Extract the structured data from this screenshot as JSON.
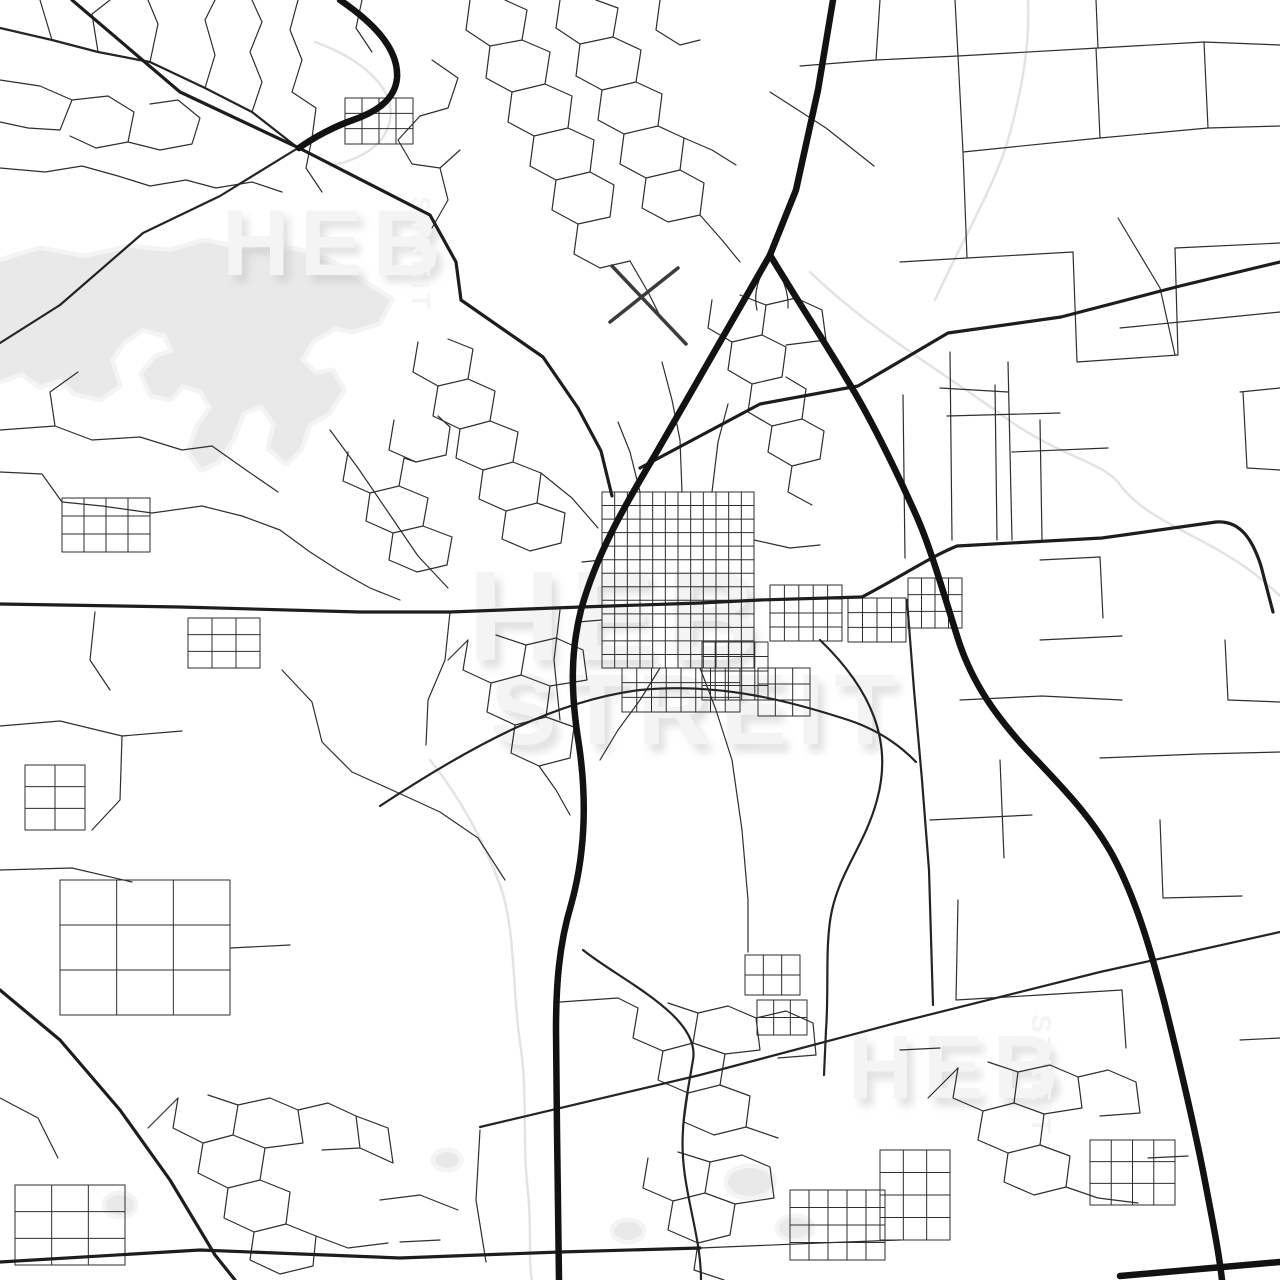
{
  "meta": {
    "background": "#ffffff",
    "image_kind": "street map poster preview"
  },
  "watermark": {
    "color": "#f4f4f4",
    "shadow_color": "#bdbdbd",
    "instances": [
      {
        "id": "center-heb",
        "text": "HEB"
      },
      {
        "id": "center-streit",
        "text": "STREIT"
      },
      {
        "id": "topleft-heb",
        "text": "HEB"
      },
      {
        "id": "topleft-streit",
        "text": "STREIT"
      },
      {
        "id": "bottomright-heb",
        "text": "HEB"
      },
      {
        "id": "bottomright-streit",
        "text": "STREIT"
      }
    ]
  },
  "map": {
    "water": {
      "fill": "#e9e9e9",
      "halo": "#f4f4f4",
      "shapes": [
        "M0,262 L40,250 L85,258 L130,248 L170,252 L205,242 L240,250 L270,246 L300,252 L330,262 L355,278 L390,300 L378,322 L352,330 L335,326 L312,340 L300,360 L315,375 L332,372 L342,390 L328,412 L308,424 L300,448 L286,462 L270,448 L276,424 L262,404 L242,412 L232,438 L218,460 L202,468 L190,452 L198,428 L212,408 L202,390 L182,384 L170,398 L152,394 L143,374 L156,358 L174,352 L166,334 L142,328 L122,342 L110,360 L118,385 L100,398 L75,392 L60,378 L40,385 L22,372 L0,380 Z",
        "M106,1205 a14,10 0 1 0 28,0 a14,10 0 1 0 -28,0 Z",
        "M728,1182 a22,14 0 1 0 44,0 a22,14 0 1 0 -44,0 Z",
        "M779,1228 a16,10 0 1 0 32,0 a16,10 0 1 0 -32,0 Z",
        "M614,1231 a14,9 0 1 0 28,0 a14,9 0 1 0 -28,0 Z",
        "M435,1160 a12,8 0 1 0 24,0 a12,8 0 1 0 -24,0 Z"
      ]
    },
    "streams": {
      "stroke": "#e3e3e3",
      "width": 2.5,
      "paths": [
        "M810,272 C870,330 940,370 1013,423 C1060,455 1100,462 1118,482 C1140,515 1190,532 1228,556 C1255,572 1268,585 1280,596",
        "M1028,0 C1030,45 1022,90 1008,140 C995,185 960,245 935,300",
        "M430,760 C462,800 485,845 500,885 C516,930 512,990 520,1042 C528,1092 522,1142 528,1192 C532,1232 528,1258 532,1280",
        "M315,42 C360,58 396,88 390,120 C385,147 358,160 330,166"
      ]
    },
    "layers": [
      {
        "name": "minor-roads",
        "type": "paths",
        "stroke": "#2e2e2e",
        "width": 1.2,
        "paths": [
          "M40,0 L52,40",
          "M98,52 L92,14 L110,0",
          "M150,62 L158,24 L148,0",
          "M205,88 L215,55 L205,20 L215,0",
          "M0,80 L40,86 L72,100 L60,130 L28,128 L0,122",
          "M72,100 L108,96 L134,112 L128,142 L96,148 L70,136",
          "M128,142 L160,150 L192,144 L200,118 L178,100 L150,104",
          "M0,168 L45,172 L82,166 L118,176",
          "M118,176 L150,186 L186,180 L216,188",
          "M216,188 L252,182 L282,192",
          "M252,112 L262,82 L250,52 L262,22 L252,0",
          "M298,0 L290,30 L302,60 L292,92",
          "M292,92 L316,108 L312,138",
          "M362,0 L356,28 L372,52",
          "M432,60 L458,78 L448,108 L420,116",
          "M420,116 L398,140 L412,164 L440,168 L460,150",
          "M440,168 L448,200 L432,228",
          "M312,138 L306,168 L322,192",
          "M470,0 L466,30 L490,46 L522,40 L527,10 L505,0",
          "M490,46 L486,78 L512,92 L545,84 L550,52 L522,40",
          "M512,92 L508,122 L534,136 L568,128 L572,96 L545,84",
          "M560,0 L556,28 L580,44 L613,37 L618,8 L596,0",
          "M580,44 L576,76 L602,90 L636,82 L641,50 L613,37",
          "M602,90 L598,120 L624,134 L658,126 L662,94 L636,82",
          "M534,136 L530,166 L556,180 L590,172 L594,140 L568,128",
          "M624,134 L620,164 L646,178 L680,170 L684,138 L658,126",
          "M646,178 L642,208 L668,222 L700,215 L704,183 L680,170",
          "M556,180 L552,210 L578,224 L610,217 L614,185 L590,172",
          "M578,224 L574,254 L600,268 L630,261",
          "M660,0 L656,30 L680,45 L700,40",
          "M684,138 L712,150 L736,165",
          "M700,215 L722,240 L740,262",
          "M630,261 L648,292 L662,320",
          "M712,300 L708,328 L732,342 L762,335 L766,305 L740,295",
          "M732,342 L728,370 L752,384 L782,377 L786,347 L762,335",
          "M752,384 L748,412 L772,426 L802,419 L806,389 L786,377",
          "M772,426 L768,452 L792,466 L820,459 L824,431 L802,419",
          "M766,305 L796,298 L822,310 L826,340 L786,345",
          "M792,466 L788,492 L812,505",
          "M770,258 C758,278 753,293 757,310",
          "M770,258 C783,276 789,292 788,308",
          "M880,0 L876,60 L958,56 L955,0",
          "M958,56 L1098,48 L1096,0",
          "M1098,48 L1204,42 L1280,45",
          "M1204,42 L1208,128 L1280,126",
          "M1096,48 L1100,138 L1208,128",
          "M958,56 L963,152 L1100,138",
          "M963,152 L967,258 L1073,252",
          "M1073,252 L1077,362 L1178,355",
          "M1178,355 L1175,248 L1280,243",
          "M967,258 L900,262",
          "M876,60 L800,66",
          "M770,92 L826,128 L874,166",
          "M1118,218 L1160,288 L1175,355",
          "M1008,362 L1010,452 L1012,540",
          "M1012,452 L1108,448",
          "M940,388 L1008,392",
          "M1240,392 L1280,388",
          "M1243,392 L1247,468 L1280,470",
          "M1120,328 L1180,322 L1280,312",
          "M903,395 L905,558",
          "M950,352 L952,540",
          "M995,385 L997,540",
          "M1040,420 L1042,540",
          "M947,416 L1060,413",
          "M0,430 L55,426 L92,440 L140,437",
          "M55,426 L50,392 L78,372",
          "M0,472 L42,474 L62,502 L102,506",
          "M140,437 L182,450 L212,446",
          "M102,506 L152,513 L202,506 L242,516",
          "M242,516 L280,530 L310,552 L338,570",
          "M212,446 L246,470 L278,492",
          "M338,570 L370,588 L400,600",
          "M418,342 L413,372 L438,386 L468,379 L473,349 L448,339",
          "M438,386 L433,416 L460,429 L490,421 L495,391 L468,379",
          "M460,429 L456,458 L483,470 L513,462 L518,432 L490,421",
          "M483,470 L479,499 L506,511 L537,503 L541,473 L513,462",
          "M506,511 L502,539 L530,551 L561,543 L565,513 L537,503",
          "M394,420 L389,450 L416,462 L446,455 L450,427 L438,416",
          "M348,452 L343,481 L370,493 L399,486 L404,458 L416,462",
          "M370,493 L366,521 L393,533 L423,526 L428,498 L399,486",
          "M393,533 L389,560 L417,572 L447,565 L452,537 L423,526",
          "M330,430 L358,468 L388,512 L418,556 L448,588",
          "M541,473 L572,498 L598,528",
          "M468,640 L463,670 L491,683 L521,675 L526,645 L496,635",
          "M491,683 L487,712 L515,725 L546,717 L550,686 L521,675",
          "M515,725 L511,753 L539,766 L570,758 L574,727 L546,717",
          "M526,645 L556,638 L583,650 L587,680 L550,686",
          "M539,766 L556,790 L570,815",
          "M448,660 L468,640",
          "M95,612 L90,660 L110,690",
          "M0,726 L60,721 L122,736 L182,731",
          "M122,736 L120,800 L92,830",
          "M282,670 L312,702 L322,742 L352,772",
          "M0,870 L72,868 L132,882",
          "M230,948 L290,945",
          "M352,772 L392,790 L440,812 L478,838",
          "M478,838 L505,880",
          "M450,612 L445,660 L428,700 L426,745",
          "M560,610 L554,660 L560,720",
          "M178,1098 L173,1128 L203,1143 L233,1135 L238,1105 L208,1095",
          "M203,1143 L198,1173 L228,1188 L260,1180 L265,1148 L233,1135",
          "M228,1188 L224,1218 L254,1232 L286,1224 L290,1192 L260,1180",
          "M254,1232 L250,1260 L280,1274 L313,1266 L316,1236 L286,1224",
          "M238,1105 L270,1098 L298,1110 L303,1143 L265,1148",
          "M298,1110 L328,1103 L356,1116 L360,1148 L322,1150",
          "M356,1116 L388,1128 L393,1163 L360,1148",
          "M148,1128 L178,1098",
          "M316,1236 L348,1248 L388,1243",
          "M0,1098 L38,1118 L58,1158",
          "M380,1200 L420,1195 L458,1210",
          "M400,1242 L440,1240",
          "M480,1130 L476,1200 L486,1262",
          "M638,1008 L633,1038 L663,1051 L693,1043 L698,1013 L668,1003",
          "M663,1051 L658,1080 L688,1093 L720,1085 L725,1054 L693,1043",
          "M688,1093 L684,1122 L714,1135 L746,1127 L750,1096 L720,1085",
          "M698,1013 L728,1006 L756,1018 L760,1050 L725,1054",
          "M756,1018 L786,1011 L813,1023 L816,1055 L778,1058",
          "M618,998 L638,1008",
          "M746,1127 L778,1138",
          "M648,1158 L643,1188 L673,1201 L705,1193 L710,1162 L678,1152",
          "M673,1201 L668,1230 L698,1243 L730,1235 L735,1204 L705,1193",
          "M698,1243 L694,1270 L724,1280",
          "M710,1162 L742,1155 L770,1167 L774,1198 L735,1204",
          "M560,1002 L618,998",
          "M700,1248 L820,1243 L900,1240",
          "M958,1068 L953,1098 L983,1111 L1014,1103 L1018,1072 L988,1062",
          "M983,1111 L978,1140 L1008,1153 L1040,1145 L1044,1114 L1014,1103",
          "M1008,1153 L1004,1182 L1034,1195 L1066,1187 L1070,1156 L1040,1145",
          "M1018,1072 L1050,1065 L1078,1077 L1082,1108 L1044,1114",
          "M1078,1077 L1108,1070 L1136,1082 L1140,1113 L1100,1116",
          "M928,1098 L958,1068",
          "M1066,1187 L1098,1198 L1138,1203",
          "M1148,1158 L1188,1156",
          "M900,1050 L940,1048",
          "M1240,1040 L1280,1038",
          "M1040,560 L1100,557",
          "M1100,557 L1103,618",
          "M1040,640 L1122,636",
          "M1225,640 L1228,700 L1280,702",
          "M960,700 L1042,696 L1122,700",
          "M1000,760 L1004,858",
          "M930,820 L1032,815",
          "M1100,758 L1200,754 L1280,752",
          "M1160,820 L1163,898 L1242,896",
          "M958,900 L956,1000 L1040,995",
          "M1040,995 L1122,990",
          "M1122,990 L1126,1048",
          "M682,492 L680,440 L672,400 L662,362",
          "M712,492 L718,442 L728,404",
          "M640,492 L630,452 L618,422",
          "M602,560 L582,562",
          "M602,620 L578,622",
          "M754,540 L790,548 L820,545",
          "M660,668 L640,700 L618,730 L600,760",
          "M700,668 L716,710 L732,760 L742,830 L748,900 L748,952"
        ]
      },
      {
        "name": "grid-roads",
        "type": "grids",
        "stroke": "#2e2e2e",
        "width": 1.0,
        "grids": [
          {
            "x": 602,
            "y": 492,
            "w": 152,
            "h": 176,
            "cols": 12,
            "rows": 13
          },
          {
            "x": 622,
            "y": 668,
            "w": 118,
            "h": 44,
            "cols": 8,
            "rows": 3
          },
          {
            "x": 702,
            "y": 642,
            "w": 66,
            "h": 58,
            "cols": 5,
            "rows": 4
          },
          {
            "x": 770,
            "y": 585,
            "w": 72,
            "h": 56,
            "cols": 5,
            "rows": 4
          },
          {
            "x": 848,
            "y": 598,
            "w": 58,
            "h": 44,
            "cols": 4,
            "rows": 3
          },
          {
            "x": 908,
            "y": 578,
            "w": 54,
            "h": 50,
            "cols": 4,
            "rows": 3
          },
          {
            "x": 758,
            "y": 668,
            "w": 52,
            "h": 48,
            "cols": 3,
            "rows": 3
          },
          {
            "x": 62,
            "y": 498,
            "w": 88,
            "h": 54,
            "cols": 4,
            "rows": 3
          },
          {
            "x": 188,
            "y": 618,
            "w": 72,
            "h": 50,
            "cols": 3,
            "rows": 3
          },
          {
            "x": 25,
            "y": 765,
            "w": 60,
            "h": 65,
            "cols": 2,
            "rows": 3
          },
          {
            "x": 60,
            "y": 880,
            "w": 170,
            "h": 135,
            "cols": 3,
            "rows": 3
          },
          {
            "x": 15,
            "y": 1185,
            "w": 110,
            "h": 80,
            "cols": 3,
            "rows": 3
          },
          {
            "x": 790,
            "y": 1190,
            "w": 95,
            "h": 70,
            "cols": 5,
            "rows": 4
          },
          {
            "x": 745,
            "y": 955,
            "w": 55,
            "h": 40,
            "cols": 3,
            "rows": 2
          },
          {
            "x": 757,
            "y": 1000,
            "w": 50,
            "h": 35,
            "cols": 3,
            "rows": 2
          },
          {
            "x": 1090,
            "y": 1140,
            "w": 85,
            "h": 65,
            "cols": 4,
            "rows": 3
          },
          {
            "x": 880,
            "y": 1150,
            "w": 70,
            "h": 90,
            "cols": 3,
            "rows": 4
          },
          {
            "x": 345,
            "y": 98,
            "w": 68,
            "h": 46,
            "cols": 4,
            "rows": 3
          }
        ]
      },
      {
        "name": "runways",
        "type": "paths",
        "stroke": "#3c3c3c",
        "width": 3.5,
        "paths": [
          "M612,266 L686,344",
          "M610,322 L678,268"
        ]
      },
      {
        "name": "medium-roads",
        "type": "paths",
        "stroke": "#242424",
        "width": 2.2,
        "paths": [
          "M0,28 L52,40 L98,52 L150,62 L205,88 L252,112 L298,148",
          "M298,148 L220,196 L143,233 L60,305 L0,343",
          "M380,806 C480,740 560,700 640,690 C720,682 792,702 842,718 C872,727 896,741 916,762",
          "M820,640 C872,690 893,742 877,800 C865,845 839,872 831,915 C825,948 829,990 826,1030 L824,1075",
          "M907,600 L914,690 L922,780 L929,870 L933,1005",
          "M583,950 C620,980 701,1016 693,1060 C687,1095 684,1110 683,1130 C679,1185 701,1230 701,1280",
          "M480,1127 L700,1075 L900,1022 L1100,972 L1280,932"
        ]
      },
      {
        "name": "major-roads",
        "type": "paths",
        "stroke": "#1d1d1d",
        "width": 3.2,
        "paths": [
          "M0,604 L180,607 L360,612 L450,612 L581,607 L700,603 L760,600 L862,597",
          "M862,597 C902,576 932,556 957,546 L1102,538 L1216,522 C1241,520 1253,541 1261,566 L1273,612",
          "M72,0 L180,92 L299,148 L430,215 L456,262 L461,300 L543,357 L578,408 L601,451 L612,496",
          "M640,468 L760,404 L858,386 L948,333 L1061,317 L1180,286 L1280,262",
          "M0,990 L60,1040 L120,1110 L170,1180 L215,1255 L235,1280",
          "M0,1262 L200,1250 L400,1258 L560,1252 L700,1248"
        ]
      },
      {
        "name": "highways",
        "type": "paths",
        "stroke": "#121212",
        "width": 6.5,
        "paths": [
          "M833,0 L818,90 L796,190 L770,255",
          "M770,255 C735,315 690,395 655,455 C625,505 596,555 581,610 C571,650 570,690 579,745 C587,800 585,855 571,905 C559,945 556,985 556,1030 L557,1130 L559,1280",
          "M770,255 C802,308 826,344 846,378 C869,415 896,470 916,515 C931,548 946,602 959,642 C973,684 996,716 1026,749 C1061,786 1091,816 1113,856 C1136,899 1151,951 1164,1001 C1179,1061 1193,1121 1203,1171 C1213,1223 1219,1253 1222,1280",
          "M1120,1276 L1280,1262",
          "M340,0 C372,22 399,48 397,78 C395,100 376,112 353,120 C333,127 313,138 299,148"
        ]
      }
    ]
  }
}
